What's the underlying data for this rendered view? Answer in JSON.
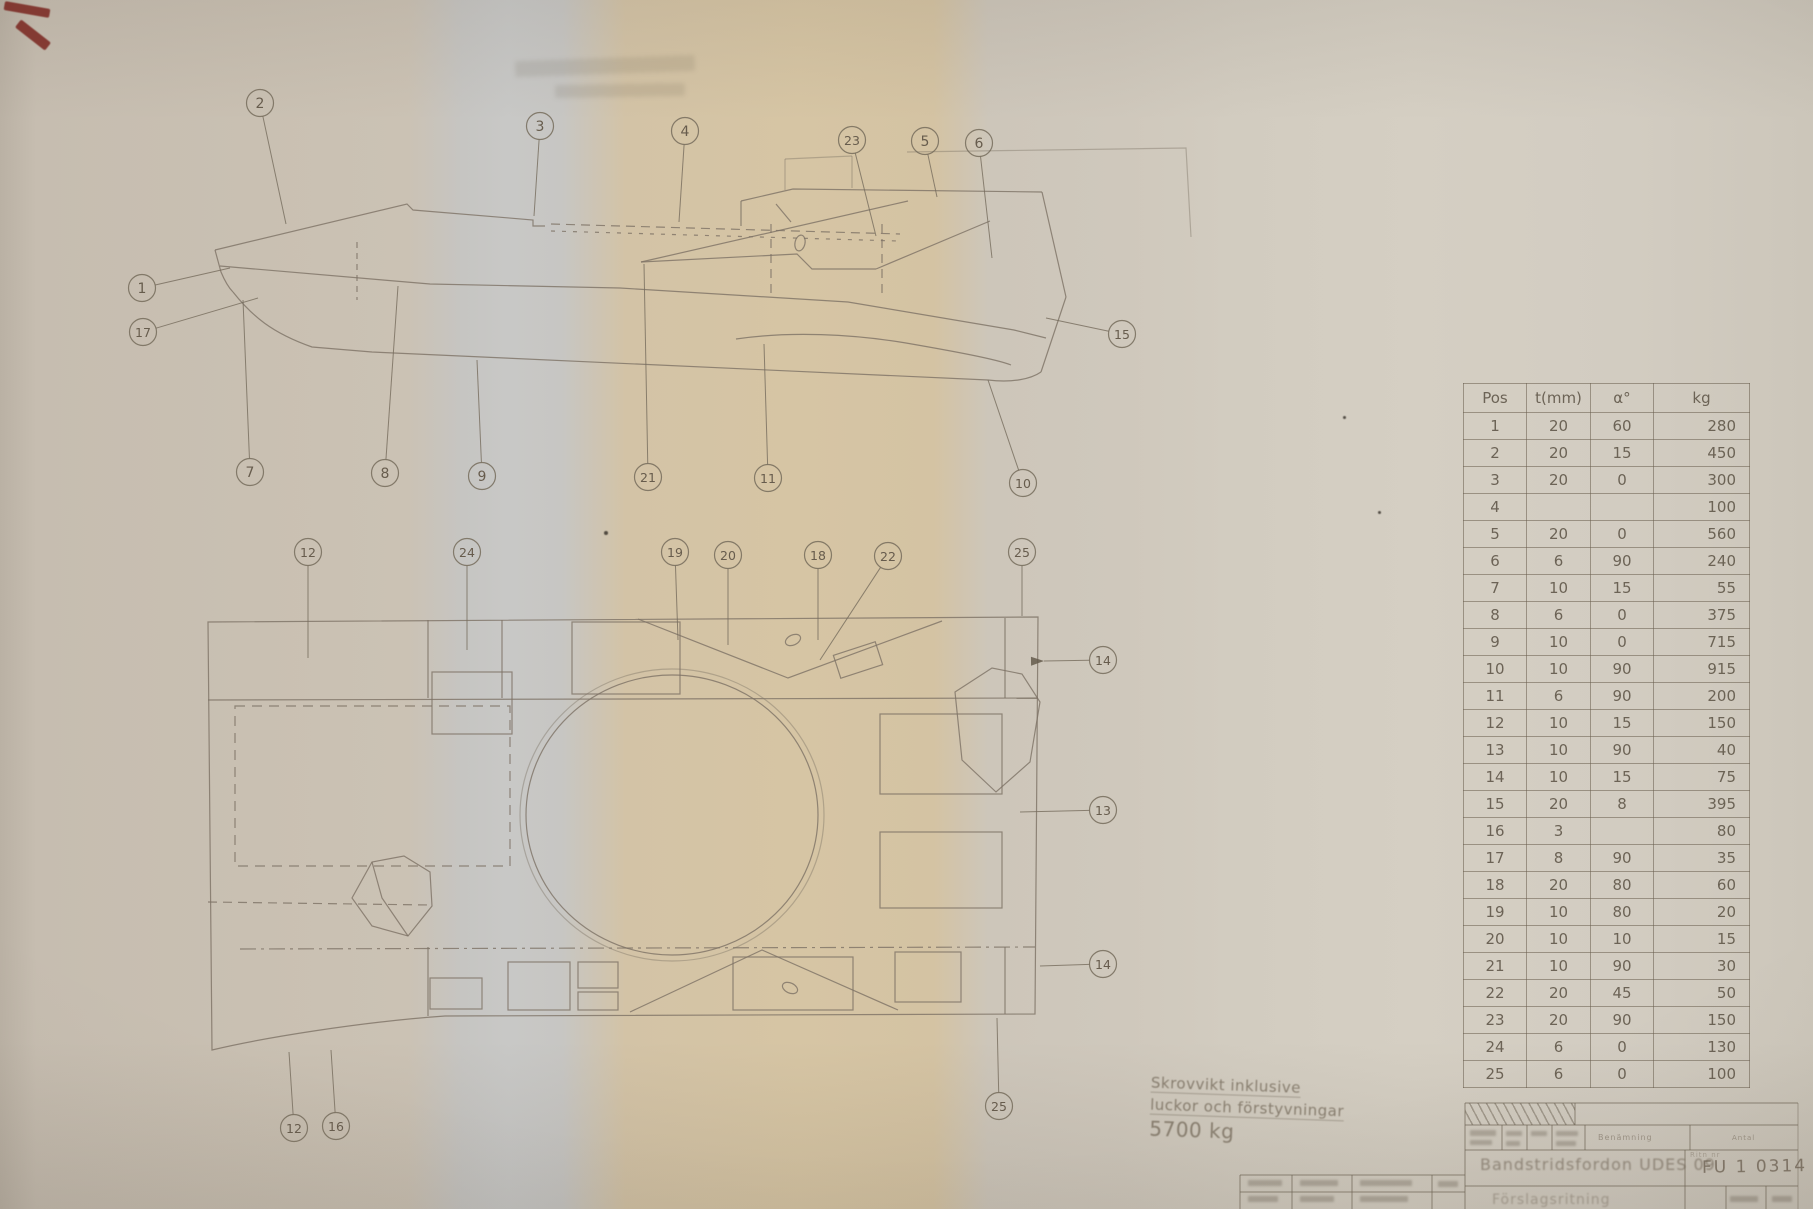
{
  "parts_table": {
    "headers": [
      "Pos",
      "t(mm)",
      "α°",
      "kg"
    ],
    "rows": [
      [
        "1",
        "20",
        "60",
        "280"
      ],
      [
        "2",
        "20",
        "15",
        "450"
      ],
      [
        "3",
        "20",
        "0",
        "300"
      ],
      [
        "4",
        "",
        "",
        "100"
      ],
      [
        "5",
        "20",
        "0",
        "560"
      ],
      [
        "6",
        "6",
        "90",
        "240"
      ],
      [
        "7",
        "10",
        "15",
        "55"
      ],
      [
        "8",
        "6",
        "0",
        "375"
      ],
      [
        "9",
        "10",
        "0",
        "715"
      ],
      [
        "10",
        "10",
        "90",
        "915"
      ],
      [
        "11",
        "6",
        "90",
        "200"
      ],
      [
        "12",
        "10",
        "15",
        "150"
      ],
      [
        "13",
        "10",
        "90",
        "40"
      ],
      [
        "14",
        "10",
        "15",
        "75"
      ],
      [
        "15",
        "20",
        "8",
        "395"
      ],
      [
        "16",
        "3",
        "",
        "80"
      ],
      [
        "17",
        "8",
        "90",
        "35"
      ],
      [
        "18",
        "20",
        "80",
        "60"
      ],
      [
        "19",
        "10",
        "80",
        "20"
      ],
      [
        "20",
        "10",
        "10",
        "15"
      ],
      [
        "21",
        "10",
        "90",
        "30"
      ],
      [
        "22",
        "20",
        "45",
        "50"
      ],
      [
        "23",
        "20",
        "90",
        "150"
      ],
      [
        "24",
        "6",
        "0",
        "130"
      ],
      [
        "25",
        "6",
        "0",
        "100"
      ]
    ]
  },
  "handwritten_note": {
    "lines": [
      "Skrovvikt inklusive",
      "luckor och förstyvningar",
      "5700 kg"
    ]
  },
  "title_block": {
    "field_labels": {
      "benamning": "Benämning",
      "antal": "Antal",
      "ritn": "Ritn nr"
    },
    "vehicle_word": "Bandstridsfordon",
    "vehicle_name": "UDES 09",
    "drawing_number": "FU 1 0314",
    "bottom_note": "Förslagsritning"
  },
  "side_view": {
    "callouts": [
      {
        "label": "2",
        "x": 260,
        "y": 103,
        "tx": 286,
        "ty": 224
      },
      {
        "label": "3",
        "x": 540,
        "y": 126,
        "tx": 534,
        "ty": 216
      },
      {
        "label": "4",
        "x": 685,
        "y": 131,
        "tx": 679,
        "ty": 222
      },
      {
        "label": "23",
        "x": 852,
        "y": 140,
        "tx": 876,
        "ty": 236
      },
      {
        "label": "5",
        "x": 925,
        "y": 141,
        "tx": 937,
        "ty": 197
      },
      {
        "label": "6",
        "x": 979,
        "y": 143,
        "tx": 992,
        "ty": 258
      },
      {
        "label": "1",
        "x": 142,
        "y": 288,
        "tx": 230,
        "ty": 268
      },
      {
        "label": "17",
        "x": 143,
        "y": 332,
        "tx": 258,
        "ty": 298
      },
      {
        "label": "15",
        "x": 1122,
        "y": 334,
        "tx": 1046,
        "ty": 318
      },
      {
        "label": "7",
        "x": 250,
        "y": 472,
        "tx": 243,
        "ty": 300
      },
      {
        "label": "8",
        "x": 385,
        "y": 473,
        "tx": 398,
        "ty": 286
      },
      {
        "label": "9",
        "x": 482,
        "y": 476,
        "tx": 477,
        "ty": 360
      },
      {
        "label": "21",
        "x": 648,
        "y": 477,
        "tx": 644,
        "ty": 264
      },
      {
        "label": "11",
        "x": 768,
        "y": 478,
        "tx": 764,
        "ty": 344
      },
      {
        "label": "10",
        "x": 1023,
        "y": 483,
        "tx": 988,
        "ty": 380
      }
    ]
  },
  "plan_view": {
    "callouts": [
      {
        "label": "12",
        "x": 308,
        "y": 552,
        "tx": 308,
        "ty": 658
      },
      {
        "label": "24",
        "x": 467,
        "y": 552,
        "tx": 467,
        "ty": 650
      },
      {
        "label": "19",
        "x": 675,
        "y": 552,
        "tx": 678,
        "ty": 640
      },
      {
        "label": "20",
        "x": 728,
        "y": 555,
        "tx": 728,
        "ty": 645
      },
      {
        "label": "18",
        "x": 818,
        "y": 555,
        "tx": 818,
        "ty": 640
      },
      {
        "label": "22",
        "x": 888,
        "y": 556,
        "tx": 820,
        "ty": 660
      },
      {
        "label": "25",
        "x": 1022,
        "y": 552,
        "tx": 1022,
        "ty": 616
      },
      {
        "label": "14",
        "x": 1103,
        "y": 660,
        "tx": 1044,
        "ty": 661,
        "arrow": true
      },
      {
        "label": "13",
        "x": 1103,
        "y": 810,
        "tx": 1020,
        "ty": 812
      },
      {
        "label": "14",
        "x": 1103,
        "y": 964,
        "tx": 1040,
        "ty": 966
      },
      {
        "label": "25",
        "x": 999,
        "y": 1106,
        "tx": 997,
        "ty": 1018
      },
      {
        "label": "12",
        "x": 294,
        "y": 1128,
        "tx": 289,
        "ty": 1052
      },
      {
        "label": "16",
        "x": 336,
        "y": 1126,
        "tx": 331,
        "ty": 1050
      }
    ]
  }
}
